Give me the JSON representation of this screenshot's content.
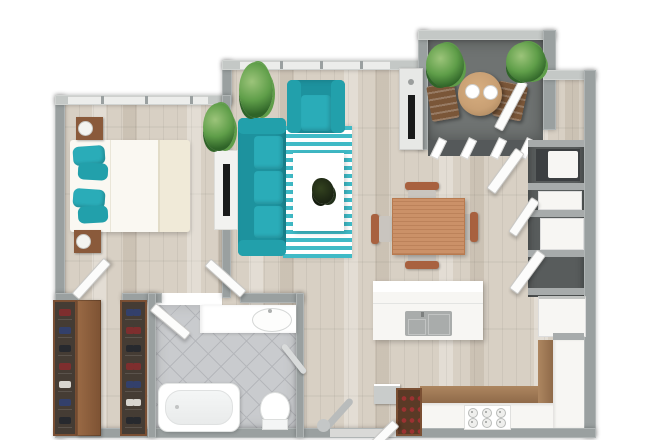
{
  "scene": {
    "type": "3d-floorplan-render",
    "description": "Top-down 3D rendering of a one-bedroom apartment floor plan with teal accent furniture",
    "rooms": [
      {
        "name": "bedroom",
        "label": "Bedroom"
      },
      {
        "name": "living-room",
        "label": "Living Room"
      },
      {
        "name": "dining-area",
        "label": "Dining Area"
      },
      {
        "name": "kitchen",
        "label": "Kitchen"
      },
      {
        "name": "bathroom",
        "label": "Bathroom"
      },
      {
        "name": "walk-in-closet",
        "label": "Walk-in Closet"
      },
      {
        "name": "balcony",
        "label": "Balcony"
      },
      {
        "name": "laundry-storage",
        "label": "Laundry / Storage Closets"
      },
      {
        "name": "hallway",
        "label": "Hallway"
      }
    ]
  },
  "labels": {
    "plan": "Apartment 3D Floor Plan",
    "bedroom": "Bedroom",
    "living": "Living Room",
    "dining": "Dining Area",
    "kitchen": "Kitchen",
    "bathroom": "Bathroom",
    "closet": "Walk-in Closet",
    "balcony": "Balcony",
    "laundry": "Laundry / Storage Closets",
    "bed": "Double bed with teal pillows",
    "nightstand": "Nightstand with lamp",
    "bedroom_tv": "Bedroom TV stand",
    "sofa": "Teal sofa",
    "armchair": "Teal armchair",
    "rug": "Striped teal rug",
    "coffee_table": "White coffee table",
    "centerpiece": "Table centerpiece plant",
    "living_tv": "Living room TV console",
    "plant": "Potted plant",
    "dining_table": "Dining table",
    "dining_chair": "Dining chair",
    "island": "Kitchen island",
    "sink": "Island sink",
    "stove": "Gas cooktop",
    "counter": "Kitchen counter",
    "fridge": "Refrigerator",
    "washer": "Washer / dryer unit",
    "appliance": "Closet appliance",
    "wine_rack": "Wine rack",
    "vanity": "Bathroom vanity with sink",
    "tub": "Bathtub",
    "toilet": "Toilet",
    "towel_bar": "Towel bar",
    "shoe_rack": "Shoe rack",
    "wardrobe": "Wardrobe cabinet",
    "balcony_table": "Round balcony table",
    "balcony_chair": "Folding balcony chair",
    "sliding_door": "Sliding glass balcony door",
    "door": "Interior door",
    "entry_door": "Entry door",
    "window": "Window"
  },
  "palette": {
    "wall": "#9aa0a0",
    "wall_top": "#c4c8c6",
    "window": "#ecedeb",
    "floor": "#d8d0c4",
    "tile": "#c9cbce",
    "tile_line": "#b5b7bb",
    "balcony_floor": "#6f7372",
    "teal": "#2aacb8",
    "teal_mid": "#22a0ab",
    "teal_dark": "#1d929e",
    "rug_teal": "#3fbac6",
    "wood_dark": "#8a5a3b",
    "rack_bg": "#453c34",
    "rack_frame": "#7a4f33",
    "dining_wood": "#cb9168",
    "dining_wood_dark": "#b87a4f",
    "chair_brown": "#a8613f",
    "balcony_wood": "#c9a074",
    "balcony_chair": "#7a5638",
    "off_white": "#f7f6f3",
    "appliance_dark": "#3c3f41",
    "niche_bg": "#585c5c",
    "divider": "#a7abab",
    "tv_black": "#191a1a",
    "console_gray": "#e7e8e6",
    "counter_tan": "#ad8660",
    "counter_tan_dark": "#8f6a49",
    "sink_gray": "#a9acab",
    "bottle_red": "#9c3232",
    "shoe_maroon": "#7e2e2e",
    "shoe_navy": "#33406b",
    "shoe_dark": "#27292e",
    "shoe_light": "#d8d5cf",
    "door_white": "#fcfcfb",
    "plant_hi": "#9cc47a",
    "plant_mid": "#5f9e49",
    "plant_dark": "#2f6428",
    "dark_plant": "#1b2413"
  }
}
